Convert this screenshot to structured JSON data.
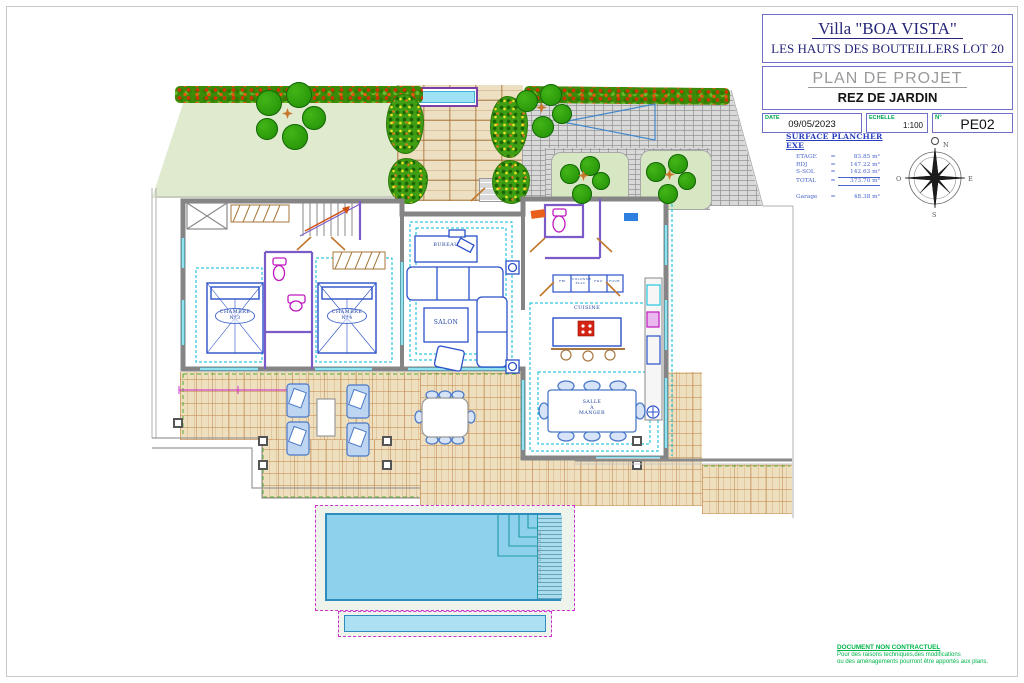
{
  "sheet": {
    "title_block": {
      "villa_name": "Villa \"BOA VISTA\"",
      "subtitle": "LES HAUTS DES BOUTEILLERS LOT 20",
      "plan_title": "PLAN DE PROJET",
      "floor_title": "REZ DE JARDIN",
      "date_label": "DATE",
      "date_value": "09/05/2023",
      "scale_label": "ECHELLE",
      "scale_value": "1:100",
      "number_label": "N°",
      "number_value": "PE02"
    }
  },
  "surface_table": {
    "title": "SURFACE PLANCHER EXE",
    "rows": [
      {
        "label": "ETAGE",
        "eq": "=",
        "value": "83.85 m²"
      },
      {
        "label": "RDJ",
        "eq": "=",
        "value": "147.22 m²"
      },
      {
        "label": "S-SOL",
        "eq": "=",
        "value": "142.63 m²"
      },
      {
        "label": "TOTAL",
        "eq": "=",
        "value": "373.70 m²"
      }
    ],
    "garage": {
      "label": "Garage",
      "eq": "=",
      "value": "48.38 m²"
    }
  },
  "compass": {
    "n": "N",
    "e": "E",
    "s": "S",
    "o": "O"
  },
  "plan": {
    "chambre3": {
      "l1": "CHAMBRE",
      "l2": "N°3"
    },
    "chambre4": {
      "l1": "CHAMBRE",
      "l2": "N°4"
    },
    "salon": "SALON",
    "bureau": "BUREAU",
    "cuisine": "CUISINE",
    "salle_a_manger": {
      "l1": "SALLE",
      "l2": "À",
      "l3": "MANGER"
    },
    "volet": "VOLET IMMERGÉ",
    "cabinets": [
      "FRI",
      "COLONNE PLAC",
      "F&O",
      "FOUR"
    ]
  },
  "disclaimer": {
    "line1": "DOCUMENT NON CONTRACTUEL",
    "line2": "Pour des raisons techniques,des modifications",
    "line3": "ou des aménagements pourront être apportés aux plans."
  },
  "colors": {
    "accent_green": "#00a651",
    "plan_blue": "#1a3fa0",
    "pool_magenta": "#cc33cc",
    "wall_gray": "#858585"
  }
}
